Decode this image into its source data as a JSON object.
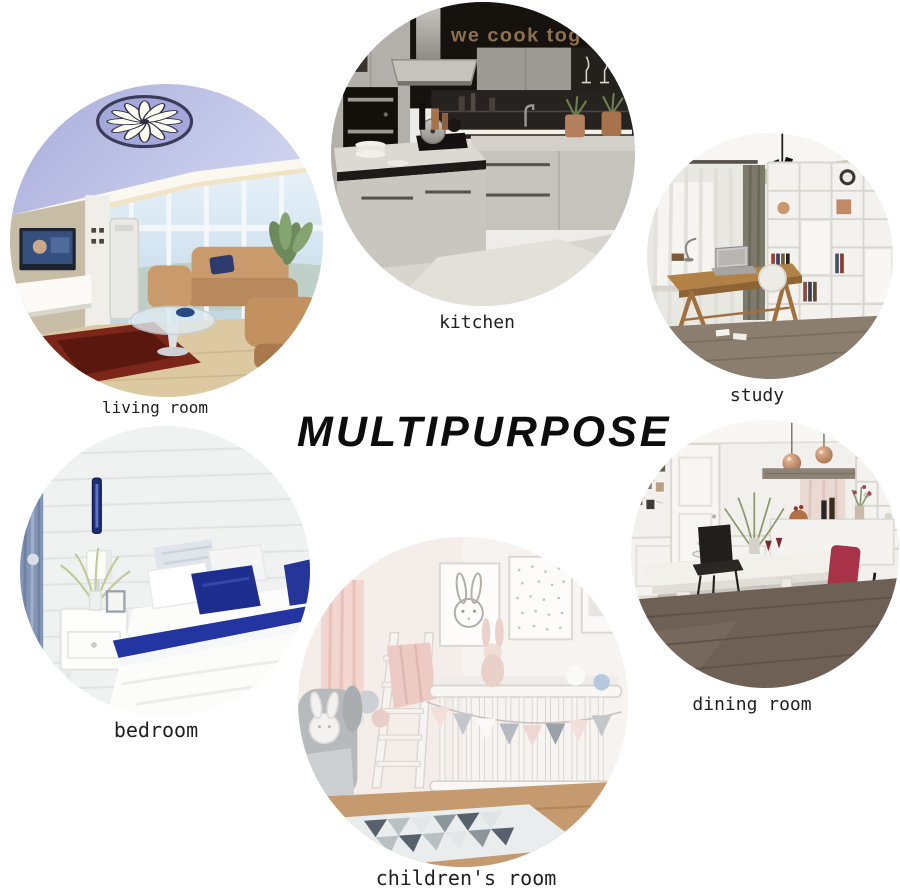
{
  "title": "MULTIPURPOSE",
  "rooms": [
    {
      "id": "living-room",
      "label": "living room"
    },
    {
      "id": "kitchen",
      "label": "kitchen",
      "wall_text": "we cook tog"
    },
    {
      "id": "study",
      "label": "study"
    },
    {
      "id": "bedroom",
      "label": "bedroom"
    },
    {
      "id": "childrens-room",
      "label": "children's room"
    },
    {
      "id": "dining-room",
      "label": "dining room"
    }
  ],
  "colors": {
    "background": "#ffffff",
    "title_text": "#0d0d0d",
    "label_text": "#1f1f1f",
    "ceiling_lavender": "#b6b9e3",
    "navy_accent": "#1e2e8e",
    "copper_accent": "#c08a66",
    "crimson_accent": "#b13a52",
    "kitchen_sign_text": "#8d7152"
  }
}
